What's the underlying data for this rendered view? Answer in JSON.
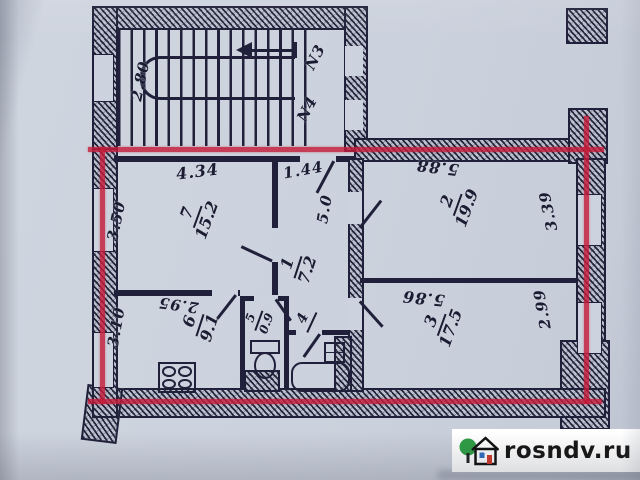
{
  "photo": {
    "watermark_text": "rosndv.ru"
  },
  "colors": {
    "paper": "#ccd2dd",
    "ink": "#20203a",
    "boundary_red": "#c51c3a",
    "watermark_bg": "#ffffff",
    "watermark_text_color": "#161616",
    "logo_green": "#2e9e45",
    "logo_door_red": "#d03a2e",
    "logo_window_blue": "#2f6fc0"
  },
  "stairwell": {
    "depth_dim": "2.80",
    "entrance_labels": {
      "n3": "N3",
      "n4": "N4"
    }
  },
  "rooms": {
    "living_room_7": {
      "number": "7",
      "area": "15.2",
      "width_dim": "4.34",
      "depth_dim": "3.50"
    },
    "hall_1": {
      "number": "1",
      "area": "7.2",
      "width_dim": "1.44",
      "length_dim": "5.0"
    },
    "room_2": {
      "number": "2",
      "area": "19.9",
      "width_dim": "5.88",
      "depth_dim": "3.39"
    },
    "room_3": {
      "number": "3",
      "area": "17.5",
      "width_dim": "5.86",
      "depth_dim": "2.99"
    },
    "kitchen_6": {
      "number": "6",
      "area": "9.1",
      "width_dim": "2.95",
      "depth_dim": "3.10"
    },
    "wc_5": {
      "number": "5",
      "area": "0.9"
    },
    "bathroom_4": {
      "number": "4",
      "area": ""
    }
  }
}
